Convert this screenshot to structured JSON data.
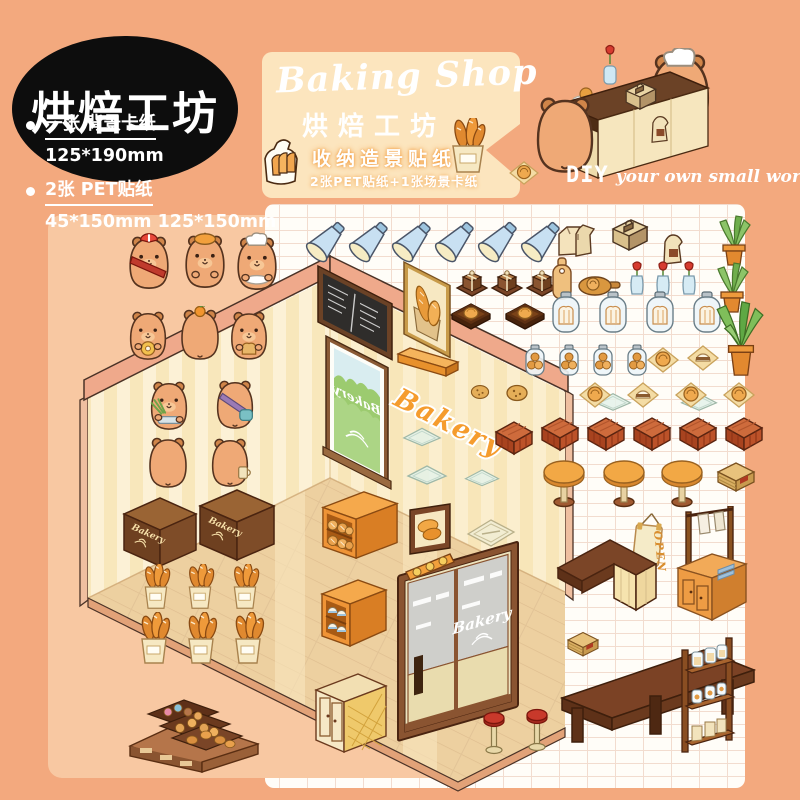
{
  "badge": {
    "title": "烘焙工坊"
  },
  "specs": {
    "items": [
      {
        "label": "一张 背景卡纸",
        "size": "125*190mm"
      },
      {
        "label": "2张 PET贴纸",
        "size": "45*150mm 125*150mm"
      }
    ]
  },
  "banner": {
    "title_en": "Baking Shop",
    "title_zh": "烘焙工坊",
    "subtitle": "收纳造景贴纸",
    "note": "2张PET贴纸+1张场景卡纸",
    "tagline_prefix": "DIY",
    "tagline": "your own small world"
  },
  "scene": {
    "wall_sign": "Bakery",
    "window_sign": "Bakery",
    "door_sign": "Bakery",
    "box_sign": "Bakery",
    "open_sign": "OPEN"
  },
  "colors": {
    "page_bg": "#F3A97E",
    "banner_bg": "#FCE5BE",
    "sheet_bg": "#FFFDF8",
    "backdrop_card": "#F8C8A2",
    "badge_bg": "#0D0D0D",
    "accent_orange": "#F59C2E",
    "wood_dark": "#6B4226",
    "wall_cream": "#FCF1D6",
    "floor_tan": "#EDD0A0"
  },
  "stickers": [
    {
      "t": "bucket-bread",
      "x": 140,
      "y": 564,
      "w": 32,
      "h": 46
    },
    {
      "t": "bucket-bread",
      "x": 184,
      "y": 564,
      "w": 32,
      "h": 46
    },
    {
      "t": "bucket-bread",
      "x": 229,
      "y": 564,
      "w": 32,
      "h": 46
    },
    {
      "t": "bucket-bread",
      "x": 136,
      "y": 612,
      "w": 36,
      "h": 54
    },
    {
      "t": "bucket-bread",
      "x": 183,
      "y": 612,
      "w": 36,
      "h": 54
    },
    {
      "t": "bucket-bread",
      "x": 230,
      "y": 612,
      "w": 36,
      "h": 54
    },
    {
      "t": "shelf-bread",
      "n": "bread-shelf",
      "x": 318,
      "y": 486,
      "w": 84,
      "h": 80
    },
    {
      "t": "shelf-domes",
      "n": "pastry-shelf",
      "x": 318,
      "y": 574,
      "w": 72,
      "h": 82
    },
    {
      "t": "bread-frame",
      "x": 408,
      "y": 502,
      "w": 46,
      "h": 54
    },
    {
      "t": "welcome-mat",
      "x": 464,
      "y": 516,
      "w": 54,
      "h": 34
    },
    {
      "t": "wall-lights",
      "x": 402,
      "y": 548,
      "w": 56,
      "h": 40
    },
    {
      "t": "glass-tray",
      "x": 400,
      "y": 424,
      "w": 44,
      "h": 24
    },
    {
      "t": "glass-tray",
      "x": 404,
      "y": 462,
      "w": 46,
      "h": 24
    },
    {
      "t": "glass-tray",
      "x": 462,
      "y": 466,
      "w": 40,
      "h": 22
    },
    {
      "t": "glass-tray",
      "x": 590,
      "y": 390,
      "w": 46,
      "h": 22
    },
    {
      "t": "glass-tray",
      "x": 676,
      "y": 390,
      "w": 46,
      "h": 22
    },
    {
      "t": "plank-shelf",
      "x": 396,
      "y": 344,
      "w": 64,
      "h": 42
    },
    {
      "t": "display-case",
      "n": "bakery-display-case",
      "x": 126,
      "y": 662,
      "w": 136,
      "h": 114
    },
    {
      "t": "cabinet-rattan",
      "x": 312,
      "y": 666,
      "w": 78,
      "h": 92
    },
    {
      "t": "lamp",
      "n": "spotlight",
      "x": 302,
      "y": 218,
      "w": 46,
      "h": 50
    },
    {
      "t": "lamp",
      "n": "spotlight",
      "x": 345,
      "y": 218,
      "w": 46,
      "h": 50
    },
    {
      "t": "lamp",
      "n": "spotlight",
      "x": 388,
      "y": 218,
      "w": 46,
      "h": 50
    },
    {
      "t": "lamp",
      "n": "spotlight",
      "x": 431,
      "y": 218,
      "w": 46,
      "h": 50
    },
    {
      "t": "lamp",
      "n": "spotlight",
      "x": 474,
      "y": 218,
      "w": 46,
      "h": 50
    },
    {
      "t": "lamp",
      "n": "spotlight",
      "x": 517,
      "y": 218,
      "w": 46,
      "h": 50
    },
    {
      "t": "paper-bags",
      "x": 556,
      "y": 220,
      "w": 40,
      "h": 40
    },
    {
      "t": "cash-register",
      "x": 606,
      "y": 214,
      "w": 46,
      "h": 44
    },
    {
      "t": "paper-bag",
      "x": 660,
      "y": 232,
      "w": 26,
      "h": 34
    },
    {
      "t": "plant-pot",
      "x": 714,
      "y": 212,
      "w": 40,
      "h": 56
    },
    {
      "t": "gift-box",
      "x": 455,
      "y": 266,
      "w": 34,
      "h": 32
    },
    {
      "t": "gift-box",
      "x": 490,
      "y": 266,
      "w": 34,
      "h": 32
    },
    {
      "t": "gift-box",
      "x": 525,
      "y": 266,
      "w": 34,
      "h": 32
    },
    {
      "t": "cutting-board",
      "x": 550,
      "y": 256,
      "w": 24,
      "h": 46
    },
    {
      "t": "serving-board",
      "x": 576,
      "y": 272,
      "w": 46,
      "h": 26
    },
    {
      "t": "flower-vase",
      "x": 627,
      "y": 260,
      "w": 20,
      "h": 38
    },
    {
      "t": "flower-vase",
      "x": 653,
      "y": 260,
      "w": 20,
      "h": 38
    },
    {
      "t": "flower-vase",
      "x": 679,
      "y": 260,
      "w": 20,
      "h": 38
    },
    {
      "t": "plant-pot",
      "x": 712,
      "y": 258,
      "w": 40,
      "h": 58
    },
    {
      "t": "tray-bun",
      "x": 450,
      "y": 296,
      "w": 42,
      "h": 36
    },
    {
      "t": "tray-bun",
      "x": 504,
      "y": 296,
      "w": 42,
      "h": 36
    },
    {
      "t": "jar-bread",
      "x": 548,
      "y": 290,
      "w": 36,
      "h": 46
    },
    {
      "t": "jar-bread",
      "x": 595,
      "y": 290,
      "w": 36,
      "h": 46
    },
    {
      "t": "jar-bread",
      "x": 642,
      "y": 290,
      "w": 36,
      "h": 46
    },
    {
      "t": "jar-bread",
      "x": 689,
      "y": 290,
      "w": 36,
      "h": 46
    },
    {
      "t": "plant-big",
      "n": "aloe-plant",
      "x": 712,
      "y": 298,
      "w": 58,
      "h": 80
    },
    {
      "t": "jar-cookie",
      "x": 522,
      "y": 344,
      "w": 26,
      "h": 34
    },
    {
      "t": "jar-cookie",
      "x": 556,
      "y": 344,
      "w": 26,
      "h": 34
    },
    {
      "t": "jar-cookie",
      "x": 590,
      "y": 344,
      "w": 26,
      "h": 34
    },
    {
      "t": "jar-cookie",
      "x": 624,
      "y": 344,
      "w": 26,
      "h": 34
    },
    {
      "t": "napkin-bun",
      "x": 646,
      "y": 346,
      "w": 34,
      "h": 28
    },
    {
      "t": "napkin-pastry",
      "x": 686,
      "y": 344,
      "w": 34,
      "h": 28
    },
    {
      "t": "cookie",
      "x": 468,
      "y": 382,
      "w": 24,
      "h": 20
    },
    {
      "t": "cookie",
      "x": 503,
      "y": 382,
      "w": 28,
      "h": 22
    },
    {
      "t": "napkin-bun",
      "x": 578,
      "y": 381,
      "w": 34,
      "h": 28
    },
    {
      "t": "napkin-pastry",
      "x": 626,
      "y": 381,
      "w": 34,
      "h": 28
    },
    {
      "t": "napkin-bun",
      "x": 674,
      "y": 381,
      "w": 34,
      "h": 28
    },
    {
      "t": "napkin-bun",
      "x": 722,
      "y": 381,
      "w": 34,
      "h": 28
    },
    {
      "t": "stool-cube",
      "n": "wicker-stool",
      "x": 492,
      "y": 418,
      "w": 44,
      "h": 40
    },
    {
      "t": "stool-cube",
      "n": "wicker-stool",
      "x": 538,
      "y": 414,
      "w": 44,
      "h": 40
    },
    {
      "t": "stool-cube",
      "n": "wicker-stool",
      "x": 584,
      "y": 414,
      "w": 44,
      "h": 40
    },
    {
      "t": "stool-cube",
      "n": "wicker-stool",
      "x": 630,
      "y": 414,
      "w": 44,
      "h": 40
    },
    {
      "t": "stool-cube",
      "n": "wicker-stool",
      "x": 676,
      "y": 414,
      "w": 44,
      "h": 40
    },
    {
      "t": "stool-cube",
      "n": "wicker-stool",
      "x": 722,
      "y": 414,
      "w": 44,
      "h": 40
    },
    {
      "t": "table-round",
      "x": 540,
      "y": 456,
      "w": 48,
      "h": 54
    },
    {
      "t": "table-round",
      "x": 600,
      "y": 456,
      "w": 48,
      "h": 54
    },
    {
      "t": "table-round",
      "x": 658,
      "y": 456,
      "w": 48,
      "h": 54
    },
    {
      "t": "crate",
      "x": 714,
      "y": 460,
      "w": 44,
      "h": 36
    },
    {
      "t": "counter-l",
      "n": "shop-counter",
      "x": 552,
      "y": 518,
      "w": 108,
      "h": 102
    },
    {
      "t": "cabinet-rack",
      "n": "towel-rack-cabinet",
      "x": 674,
      "y": 506,
      "w": 76,
      "h": 118
    },
    {
      "t": "crate",
      "x": 564,
      "y": 630,
      "w": 38,
      "h": 30
    },
    {
      "t": "bench",
      "n": "wood-table",
      "x": 554,
      "y": 636,
      "w": 208,
      "h": 122
    },
    {
      "t": "stool-red",
      "x": 482,
      "y": 710,
      "w": 24,
      "h": 48
    },
    {
      "t": "stool-red",
      "x": 525,
      "y": 707,
      "w": 24,
      "h": 48
    },
    {
      "t": "rack-shelf",
      "n": "bread-rack",
      "x": 676,
      "y": 634,
      "w": 64,
      "h": 124
    },
    {
      "t": "capy-sash",
      "n": "capybara-sash",
      "x": 126,
      "y": 232,
      "w": 46,
      "h": 60
    },
    {
      "t": "capy-beret",
      "n": "capybara-beret",
      "x": 182,
      "y": 230,
      "w": 46,
      "h": 62
    },
    {
      "t": "capy-chef",
      "n": "capybara-chef",
      "x": 234,
      "y": 232,
      "w": 46,
      "h": 62
    },
    {
      "t": "capy-donut",
      "n": "capybara-donut",
      "x": 126,
      "y": 308,
      "w": 44,
      "h": 54
    },
    {
      "t": "capy-orange-back",
      "n": "capybara-orange",
      "x": 178,
      "y": 306,
      "w": 44,
      "h": 56
    },
    {
      "t": "capy-bread",
      "n": "capybara-bread",
      "x": 228,
      "y": 308,
      "w": 42,
      "h": 54
    },
    {
      "t": "capy-greens",
      "n": "capybara-tray",
      "x": 146,
      "y": 378,
      "w": 46,
      "h": 54
    },
    {
      "t": "capy-satchel-back",
      "n": "capybara-satchel",
      "x": 212,
      "y": 377,
      "w": 46,
      "h": 54
    },
    {
      "t": "capy-back",
      "n": "capybara-back",
      "x": 146,
      "y": 434,
      "w": 44,
      "h": 56
    },
    {
      "t": "capy-cup-back",
      "n": "capybara-cup",
      "x": 208,
      "y": 435,
      "w": 44,
      "h": 54
    },
    {
      "t": "bread-icon",
      "x": 262,
      "y": 136,
      "w": 44,
      "h": 50
    },
    {
      "t": "basket-baguettes",
      "x": 448,
      "y": 118,
      "w": 40,
      "h": 56
    },
    {
      "t": "napkin-bun",
      "x": 506,
      "y": 160,
      "w": 36,
      "h": 26
    },
    {
      "t": "capy-back",
      "n": "capybara-customer",
      "x": 532,
      "y": 92,
      "w": 66,
      "h": 84
    }
  ]
}
